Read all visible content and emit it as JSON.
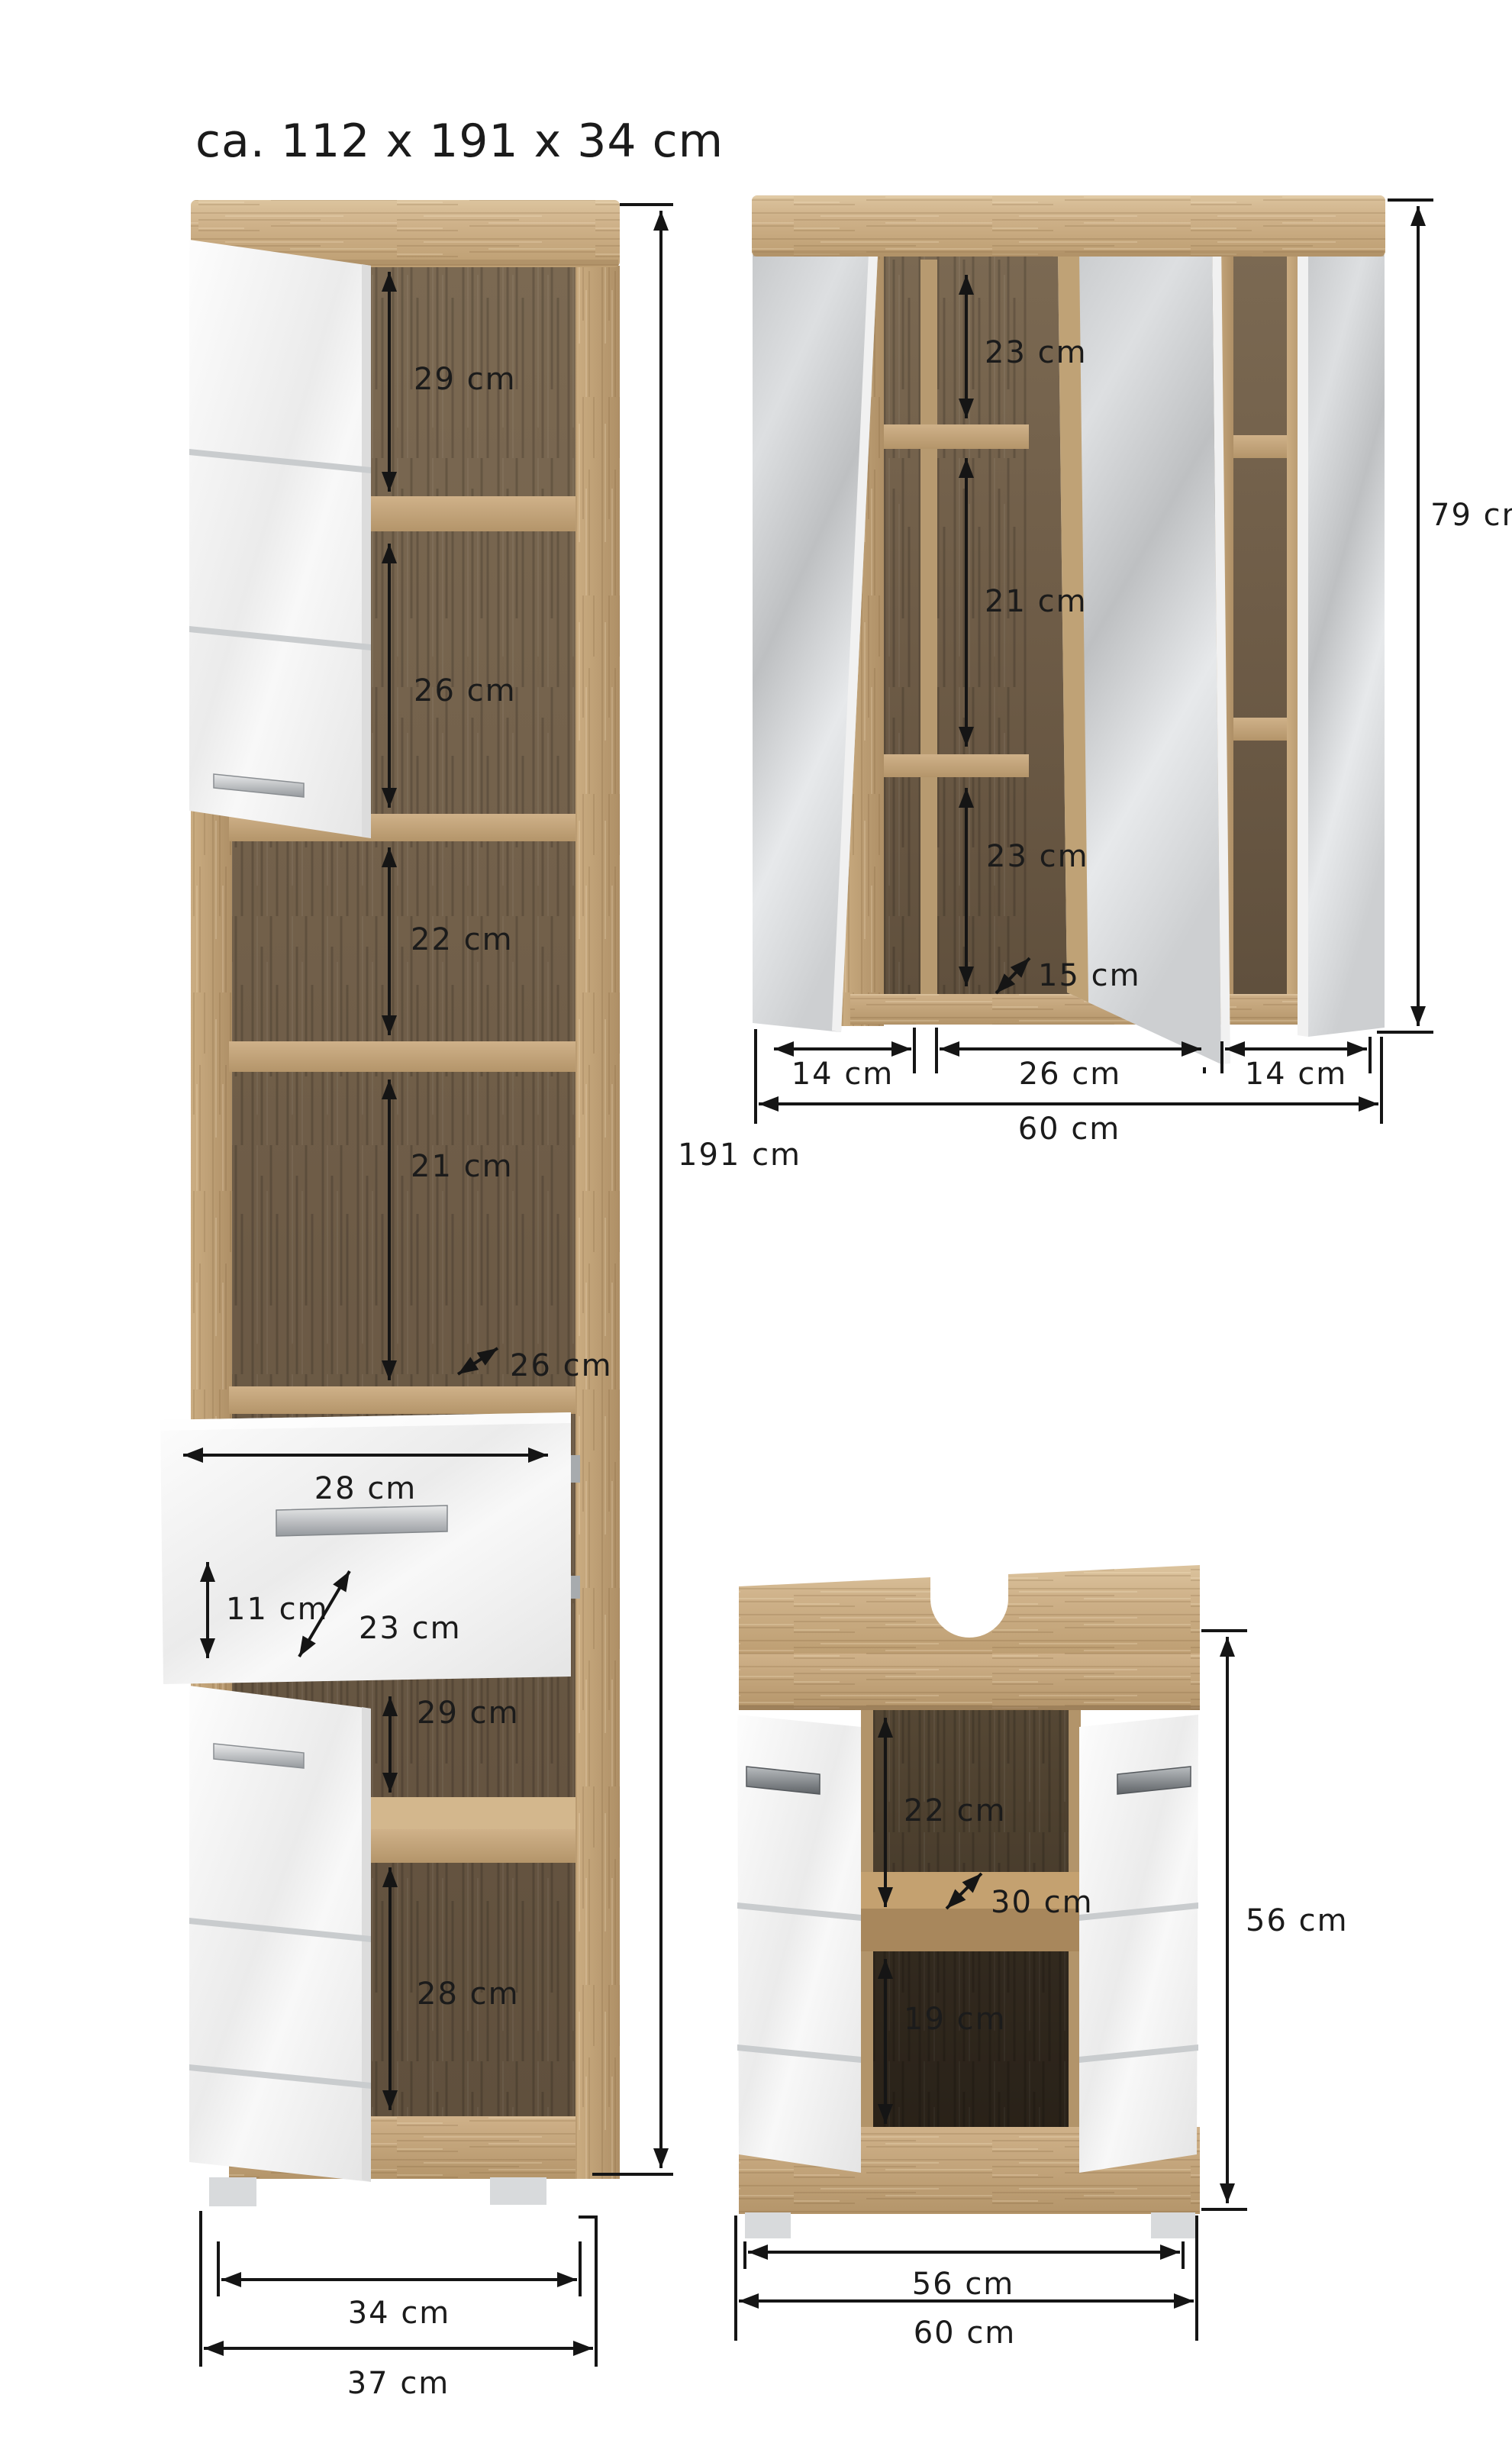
{
  "title": "ca. 112 x 191 x 34 cm",
  "colors": {
    "background": "#ffffff",
    "oak_light": "#d8c09a",
    "oak_mid": "#c6a77c",
    "oak_dark": "#a98a60",
    "interior_dark": "#71604c",
    "interior_darker": "#43372b",
    "door_white": "#f5f5f5",
    "mirror_gray": "#cdcfd1",
    "handle_silver": "#aeb2b6",
    "dimension_line": "#151515"
  },
  "tall_cabinet": {
    "dims": {
      "shelf1": "29 cm",
      "shelf2": "26 cm",
      "shelf3": "22 cm",
      "shelf4": "21 cm",
      "depth": "26 cm",
      "drawer_width": "28 cm",
      "drawer_front_height": "11 cm",
      "drawer_depth": "23 cm",
      "shelf5": "29 cm",
      "shelf6": "28 cm",
      "height": "191 cm",
      "width_feet": "34 cm",
      "width_total": "37 cm"
    }
  },
  "mirror_cabinet": {
    "dims": {
      "shelf_top": "23 cm",
      "shelf_middle": "21 cm",
      "shelf_bottom": "23 cm",
      "depth": "15 cm",
      "door_left": "14 cm",
      "door_center": "26 cm",
      "door_right": "14 cm",
      "width_total": "60 cm",
      "height": "79 cm"
    }
  },
  "vanity_cabinet": {
    "dims": {
      "upper": "22 cm",
      "shelf_depth": "30 cm",
      "lower": "19 cm",
      "height": "56 cm",
      "width_inner": "56 cm",
      "width_total": "60 cm"
    }
  }
}
